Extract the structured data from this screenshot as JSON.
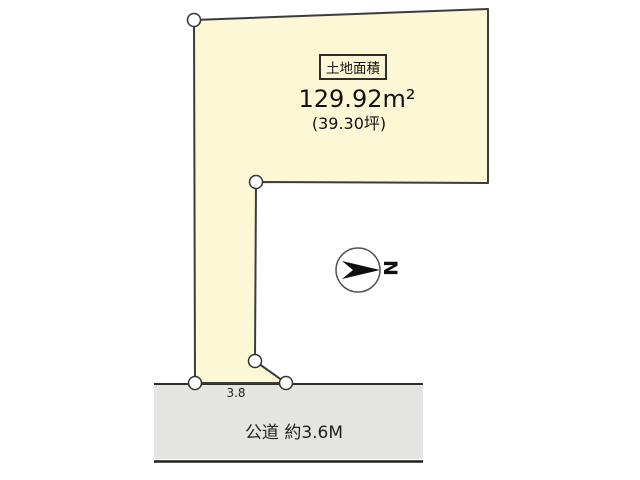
{
  "parcel": {
    "area_label": "土地面積",
    "area_value": "129.92m²",
    "area_tsubo": "(39.30坪)",
    "frontage_dimension": "3.8"
  },
  "road": {
    "label": "公道 約3.6M"
  },
  "compass": {
    "north_label": "N"
  },
  "colors": {
    "parcel_fill": "#FCF7D4",
    "road_fill": "#E4E4E2",
    "outline": "#3C3C3C",
    "marker_fill": "#FFFFFF"
  }
}
